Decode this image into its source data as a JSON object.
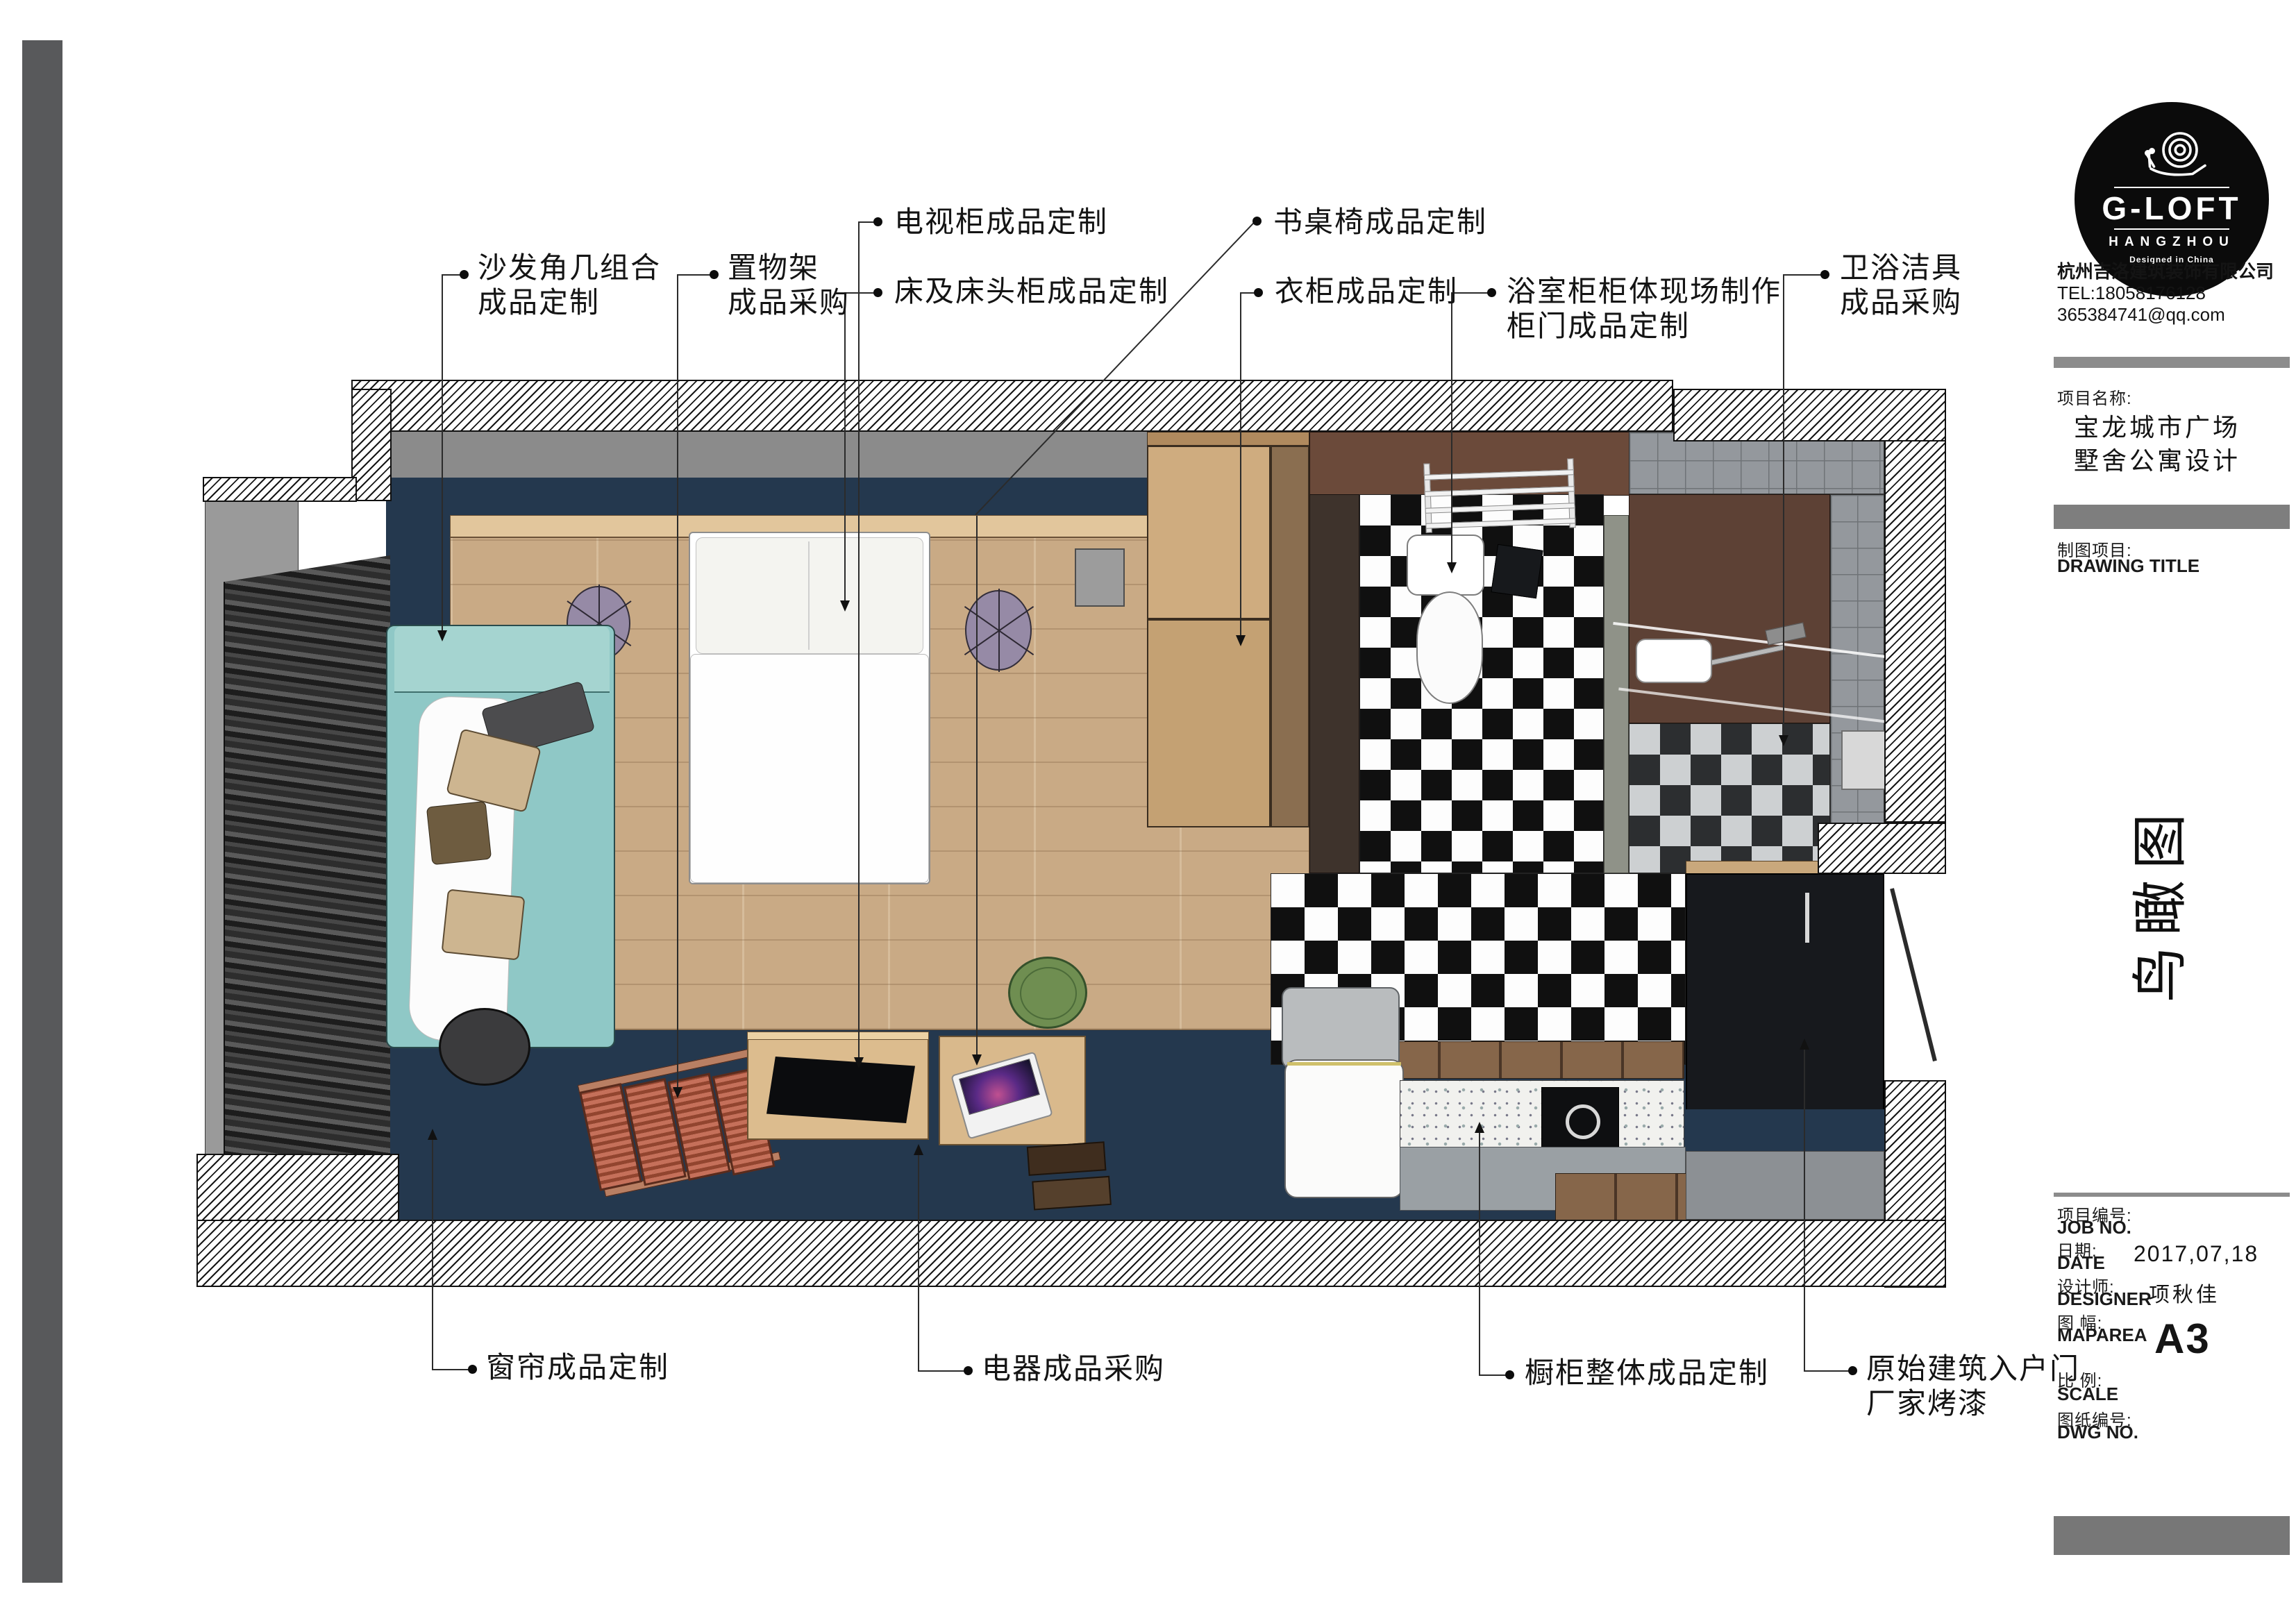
{
  "annotations": {
    "top": [
      {
        "line1": "沙发角几组合",
        "line2": "成品定制"
      },
      {
        "line1": "置物架",
        "line2": "成品采购"
      },
      {
        "line1": "电视柜成品定制",
        "line2": ""
      },
      {
        "line1": "床及床头柜成品定制",
        "line2": ""
      },
      {
        "line1": "书桌椅成品定制",
        "line2": ""
      },
      {
        "line1": "衣柜成品定制",
        "line2": ""
      },
      {
        "line1": "浴室柜柜体现场制作",
        "line2": "柜门成品定制"
      },
      {
        "line1": "卫浴洁具",
        "line2": "成品采购"
      }
    ],
    "bottom": [
      {
        "line1": "窗帘成品定制",
        "line2": ""
      },
      {
        "line1": "电器成品采购",
        "line2": ""
      },
      {
        "line1": "橱柜整体成品定制",
        "line2": ""
      },
      {
        "line1": "原始建筑入户门",
        "line2": "厂家烤漆"
      }
    ]
  },
  "title_block": {
    "logo": {
      "brand": "G-LOFT",
      "city": "HANGZHOU",
      "tagline": "Designed in China"
    },
    "company": {
      "name": "杭州吉洛建筑装饰有限公司",
      "tel": "TEL:18058176128",
      "email": "365384741@qq.com"
    },
    "project": {
      "label": "项目名称:",
      "name_line1": "宝龙城市广场",
      "name_line2": "墅舍公寓设计"
    },
    "drawing": {
      "label": "制图项目:",
      "sublabel": "DRAWING TITLE",
      "title": "鸟瞰图"
    },
    "fields": [
      {
        "zh": "项目编号:",
        "en": "JOB NO.",
        "value": ""
      },
      {
        "zh": "日期:",
        "en": "DATE",
        "value": "2017,07,18"
      },
      {
        "zh": "设计师:",
        "en": "DESIGNER",
        "value": "项秋佳"
      },
      {
        "zh": "图  幅:",
        "en": "MAPAREA",
        "value": "A3"
      },
      {
        "zh": "比  例:",
        "en": "SCALE",
        "value": ""
      },
      {
        "zh": "图纸编号:",
        "en": "DWG NO.",
        "value": ""
      }
    ]
  },
  "colors": {
    "navy": "#24384e",
    "wood_floor": "#c9aa85",
    "teal_sofa": "#8fc8c6",
    "bath_brown": "#6b4a3a",
    "black_cabinet": "#17191d",
    "accent_bar": "#8c8c8c",
    "page_edge_bar": "#58595b"
  }
}
